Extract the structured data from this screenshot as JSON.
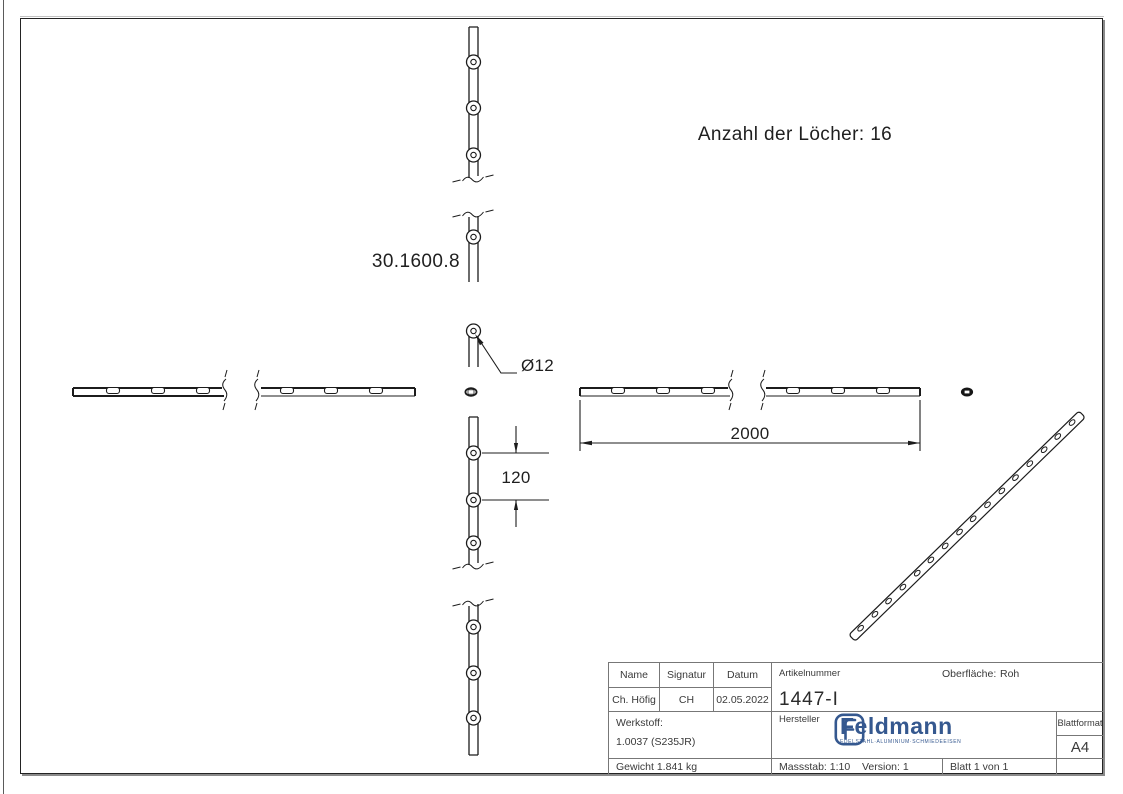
{
  "annotations": {
    "holes_note": "Anzahl der Löcher: 16",
    "part_code": "30.1600.8",
    "dim_length": "2000",
    "dim_spacing": "120",
    "dim_hole_dia": "Ø12"
  },
  "title_block": {
    "col_name": "Name",
    "col_signatur": "Signatur",
    "col_datum": "Datum",
    "val_name": "Ch. Höfig",
    "val_signatur": "CH",
    "val_datum": "02.05.2022",
    "artikelnummer_label": "Artikelnummer",
    "artikelnummer_value": "1447-I",
    "oberflaeche_label": "Oberfläche:",
    "oberflaeche_value": "Roh",
    "werkstoff_label": "Werkstoff:",
    "werkstoff_value": "1.0037 (S235JR)",
    "hersteller_label": "Hersteller",
    "blattformat_label": "Blattformat",
    "blattformat_value": "A4",
    "gewicht_value": "Gewicht 1.841 kg",
    "massstab_value": "Massstab: 1:10",
    "version_value": "Version: 1",
    "blatt_value": "Blatt 1 von 1",
    "logo": {
      "letter": "F",
      "name": "Feldmann",
      "tagline": "EDELSTAHL·ALUMINIUM·SCHMIEDEEISEN",
      "color": "#35588f"
    }
  }
}
